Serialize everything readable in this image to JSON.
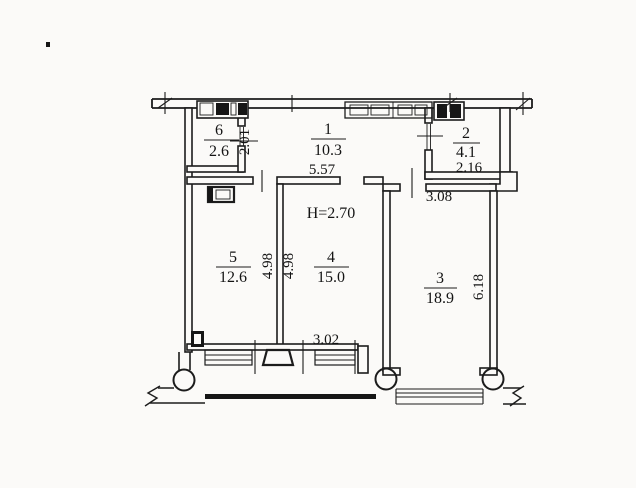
{
  "document": {
    "kind": "scanned apartment floor plan drawing",
    "paper_color": "#fbfaf8",
    "ink_color": "#1c1c1c"
  },
  "ceiling_height_note": "H=2.70",
  "rooms": [
    {
      "number": "1",
      "area": "10.3"
    },
    {
      "number": "2",
      "area": "4.1",
      "width_dim": "2.16"
    },
    {
      "number": "3",
      "area": "18.9"
    },
    {
      "number": "4",
      "area": "15.0"
    },
    {
      "number": "5",
      "area": "12.6"
    },
    {
      "number": "6",
      "area": "2.6"
    }
  ],
  "dimensions": {
    "hall_width": "5.57",
    "closet_wall": "2.01",
    "room3_entry_width": "3.08",
    "room5_depth": "4.98",
    "room4_depth": "4.98",
    "room4_width": "3.02",
    "room3_depth": "6.18"
  }
}
